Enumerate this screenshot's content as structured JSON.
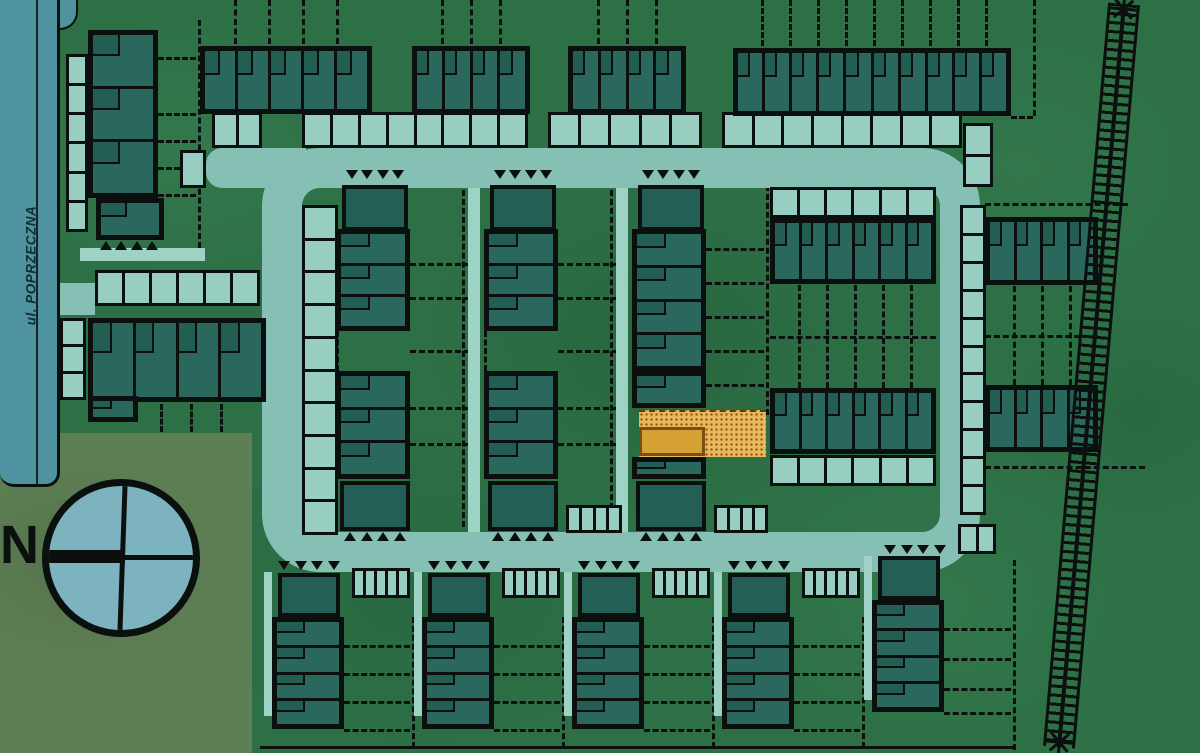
{
  "site_plan": {
    "street_label": "ul. POPRZECZNA",
    "compass_north_label": "N"
  },
  "selected_plot": {
    "state": "highlighted",
    "plot_fill": "#E7B85C",
    "building_fill": "#D6A134",
    "outline_color": "#7A4F13"
  },
  "palette": {
    "grass_green": "#2D7046",
    "lawn_olive": "#5E7E54",
    "road_teal": "#86BFB3",
    "parking_teal": "#98CDC1",
    "street_blue": "#4F93A1",
    "building_teal": "#2A675C",
    "building_dark": "#235F54",
    "outline_black": "#0B100E",
    "compass_fill": "#7CB3BF"
  }
}
